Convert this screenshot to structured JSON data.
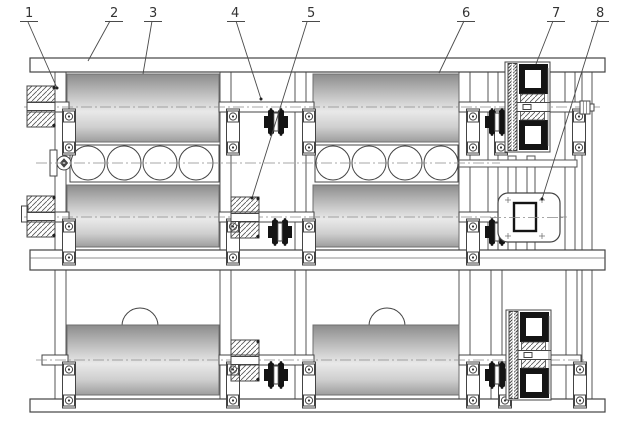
{
  "diagram": {
    "type": "technical-assembly-drawing",
    "description": "Front view of a two-tier roller (jar) mill frame with numbered part callouts",
    "labels": [
      {
        "text": "1"
      },
      {
        "text": "2"
      },
      {
        "text": "3"
      },
      {
        "text": "4"
      },
      {
        "text": "5"
      },
      {
        "text": "6"
      },
      {
        "text": "7"
      },
      {
        "text": "8"
      }
    ],
    "colors": {
      "line": "#444444",
      "black": "#141414",
      "paper": "#ffffff",
      "roller_dark": "#8c8c8c",
      "roller_mid": "#b9b9b9",
      "roller_light": "#e9e9e9"
    }
  }
}
